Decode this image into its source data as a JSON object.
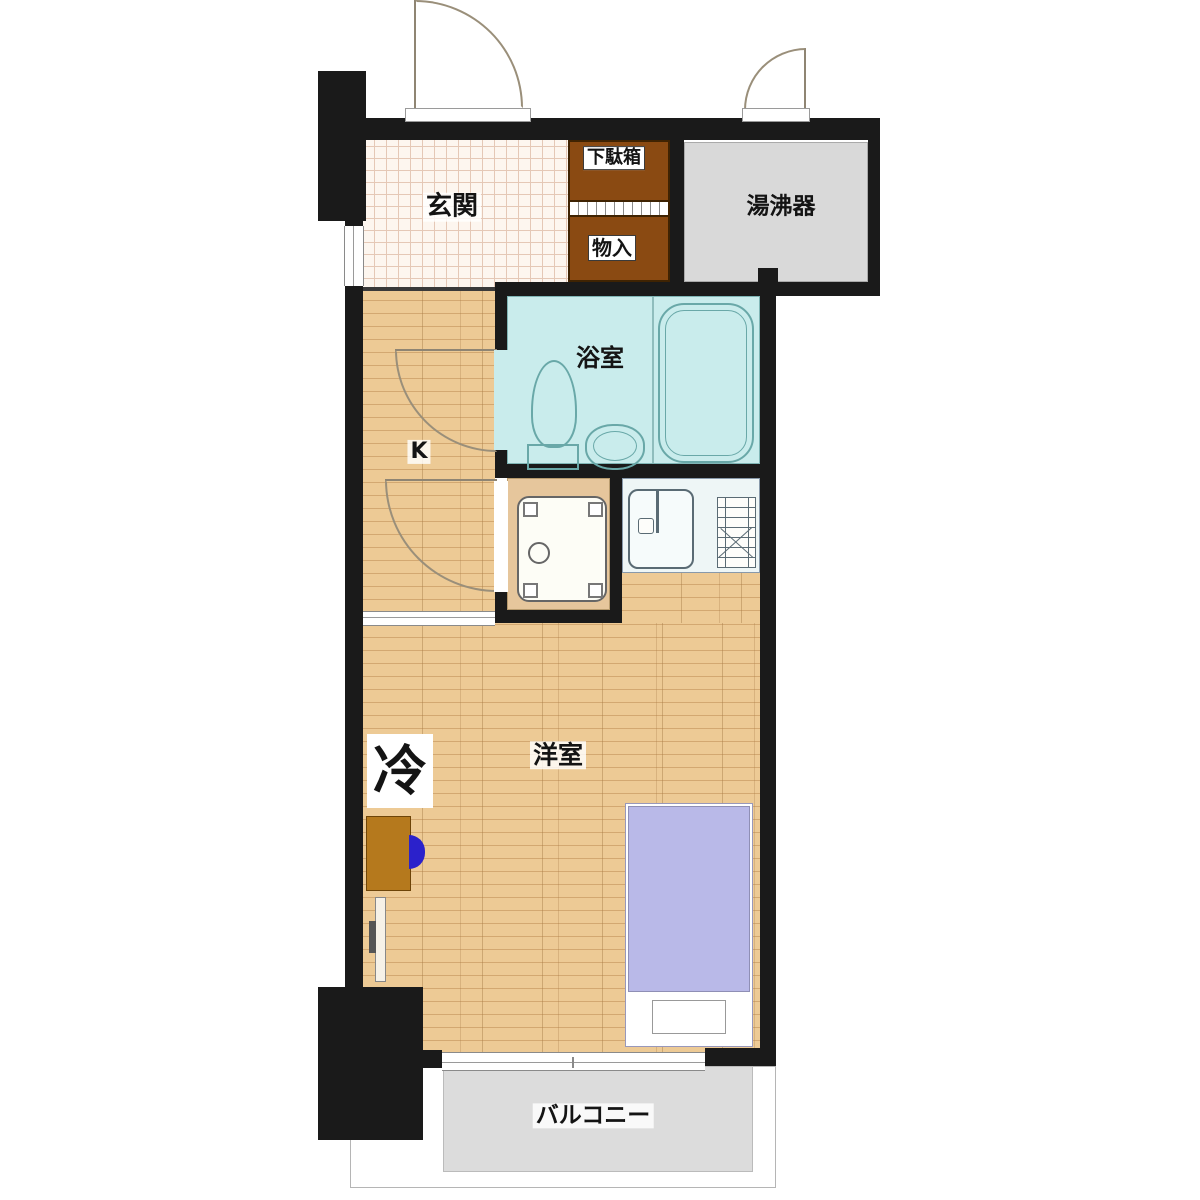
{
  "title": "1K apartment floor plan",
  "labels": {
    "genkan": "玄関",
    "shoe_cabinet": "下駄箱",
    "storage": "物入",
    "water_heater": "湯沸器",
    "bathroom": "浴室",
    "kitchen": "K",
    "western_room": "洋室",
    "refrigerator": "冷",
    "balcony": "バルコニー"
  },
  "colors": {
    "wall": "#1a1a1a",
    "wood_floor": "#edca95",
    "wood_line": "#d3a871",
    "entry_tile_bg": "#fdf6ef",
    "entry_tile_line": "#e5c8b6",
    "bathroom_fill": "#c9ecec",
    "fixture_line": "#69a8a8",
    "utility_gray": "#d9d9d9",
    "balcony_gray": "#dcdcdc",
    "cabinet_brown": "#8a4a12",
    "bed_purple": "#b9b9e8",
    "desk_brown": "#b5791d",
    "chair_blue": "#2b21cb",
    "counter_fill": "#eef6f6"
  }
}
